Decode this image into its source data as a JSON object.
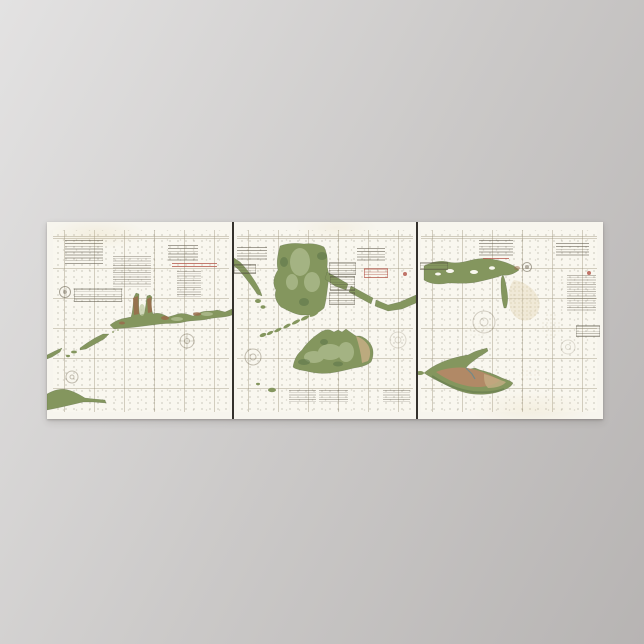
{
  "scene": {
    "kind": "product photo of a poster print",
    "background": "studio gray gradient backdrop",
    "poster_subject": "antique U.S. Coast Survey style triptych nautical chart of the southern New England coast",
    "legible_text": "none - all engraved chart lettering is below legibility at this resolution"
  },
  "poster": {
    "orientation": "wide horizontal triptych, three butted chart sheets separated by dark joins",
    "panels": [
      {
        "id": "left",
        "name": "connecticut-shore-chart",
        "features": [
          "connecticut-coastline",
          "river-estuaries",
          "fishers-island",
          "long-island-north-fork-tip",
          "compass-roses",
          "title-blocks",
          "red-scale-bars",
          "survey-seal",
          "tide-table"
        ]
      },
      {
        "id": "middle",
        "name": "buzzards-bay-vineyard-sound-chart",
        "features": [
          "buzzards-bay-shores",
          "falmouth-shore-band",
          "elizabeth-islands-chain",
          "marthas-vineyard-island",
          "chappaquiddick-lobe",
          "outlying-islets",
          "title-blocks",
          "tide-tables",
          "note-paragraphs"
        ]
      },
      {
        "id": "right",
        "name": "nantucket-chart",
        "features": [
          "cape-cod-south-shore",
          "monomoy-spit",
          "nantucket-island",
          "great-point-spit",
          "tuckernuck-islet",
          "shoal-stippling",
          "title-blocks",
          "notes-paragraph",
          "survey-seal"
        ]
      }
    ],
    "frame": "gold double neatline with engraved tick marks",
    "water_texture": "graticule grid with scattered sounding dots"
  },
  "theme": {
    "colors": {
      "bg-top": "#e3e2e2",
      "bg-mid": "#cbc9c8",
      "bg-bottom": "#b7b4b3",
      "sheet": "#f7f5ee",
      "water": "#f9f7ef",
      "frame-gold": "#c2a050",
      "divider": "#34312c",
      "land": "#84965e",
      "land-light": "#bac79c",
      "land-dark": "#5c744a",
      "land-rust": "#9a6c4c",
      "pink-land": "#bd8668",
      "sand": "#c6ae84",
      "shoal": "#e7dcc0",
      "harbor": "#6b8a8c"
    }
  }
}
